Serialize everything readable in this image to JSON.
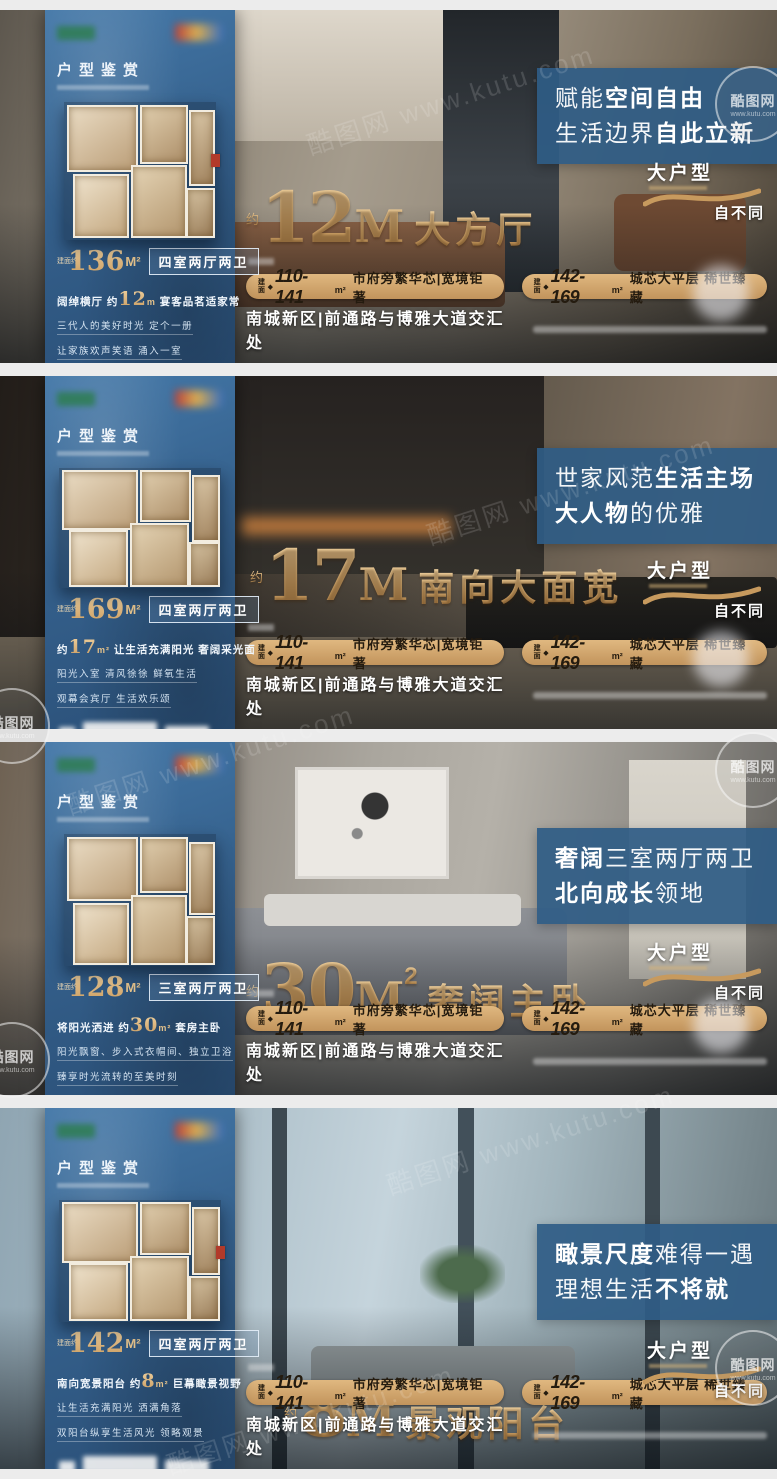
{
  "watermark": {
    "name": "酷图网",
    "domain": "www.kutu.com"
  },
  "colors": {
    "panel_blue": "#35618d",
    "gold": "#caa06a",
    "headline_box": "#2f5c8a",
    "pill_gold": "#c2945c"
  },
  "shared": {
    "brand_label": "户型鉴赏",
    "badge": {
      "line1": "大户型",
      "line2": "自不同"
    },
    "area_prefix": "建面约",
    "pills": [
      {
        "prefix": "建面",
        "bullet": "◆",
        "range": "110-141",
        "unit": "m²",
        "desc": "市府旁繁华芯|宽境钜著"
      },
      {
        "prefix": "建面",
        "bullet": "◆",
        "range": "142-169",
        "unit": "m²",
        "desc": "城芯大平层 稀世臻藏"
      }
    ],
    "location": "南城新区|前通路与博雅大道交汇处"
  },
  "banners": [
    {
      "headline": {
        "s1": {
          "t": "赋能",
          "b": false
        },
        "s2": {
          "t": "空间自由",
          "b": true
        },
        "s3": {
          "t": "生活边界",
          "b": false
        },
        "s4": {
          "t": "自此立新",
          "b": true
        }
      },
      "gold": {
        "prefix": "约",
        "num": "12",
        "unit": "M",
        "sup": "",
        "label": "大方厅"
      },
      "area": {
        "num": "136",
        "unit": "M²",
        "type": "四室两厅两卫"
      },
      "feature": {
        "pre": "阔绰横厅 约",
        "num": "12",
        "unit": "m",
        "post": " 宴客品茗适家常"
      },
      "desc2": "三代人的美好时光 定个一册",
      "desc3": "让家族欢声笑语 涌入一室"
    },
    {
      "headline": {
        "s1": {
          "t": "世家风范",
          "b": false
        },
        "s2": {
          "t": "生活主场",
          "b": true
        },
        "s3": {
          "t": "大人物",
          "b": true
        },
        "s4": {
          "t": "的优雅",
          "b": false
        }
      },
      "gold": {
        "prefix": "约",
        "num": "17",
        "unit": "M",
        "sup": "",
        "label": "南向大面宽"
      },
      "area": {
        "num": "169",
        "unit": "M²",
        "type": "四室两厅两卫"
      },
      "feature": {
        "pre": "约",
        "num": "17",
        "unit": "m²",
        "post": " 让生活充满阳光 奢阔采光面"
      },
      "desc2": "阳光入室 清风徐徐 鲜氧生活",
      "desc3": "观幕会宾厅 生活欢乐颂"
    },
    {
      "headline": {
        "s1": {
          "t": "奢阔",
          "b": true
        },
        "s2": {
          "t": "三室两厅两卫",
          "b": false
        },
        "s3": {
          "t": "北向成长",
          "b": true
        },
        "s4": {
          "t": "领地",
          "b": false
        }
      },
      "gold": {
        "prefix": "约",
        "num": "30",
        "unit": "M",
        "sup": "2",
        "label": "奢阔主卧"
      },
      "area": {
        "num": "128",
        "unit": "M²",
        "type": "三室两厅两卫"
      },
      "feature": {
        "pre": "将阳光洒进 约",
        "num": "30",
        "unit": "m²",
        "post": " 套房主卧"
      },
      "desc2": "阳光飘窗、步入式衣帽间、独立卫浴",
      "desc3": "臻享时光流转的至美时刻"
    },
    {
      "headline": {
        "s1": {
          "t": "瞰景尺度",
          "b": true
        },
        "s2": {
          "t": "难得一遇",
          "b": false
        },
        "s3": {
          "t": "理想生活",
          "b": false
        },
        "s4": {
          "t": "不将就",
          "b": true
        }
      },
      "gold": {
        "prefix": "约",
        "num": "8",
        "unit": "M",
        "sup": "",
        "label": "景观阳台"
      },
      "area": {
        "num": "142",
        "unit": "M²",
        "type": "四室两厅两卫"
      },
      "feature": {
        "pre": "南向宽景阳台 约",
        "num": "8",
        "unit": "m²",
        "post": " 巨幕瞰景视野"
      },
      "desc2": "让生活充满阳光 洒满角落",
      "desc3": "双阳台纵享生活风光 领略观景"
    }
  ]
}
